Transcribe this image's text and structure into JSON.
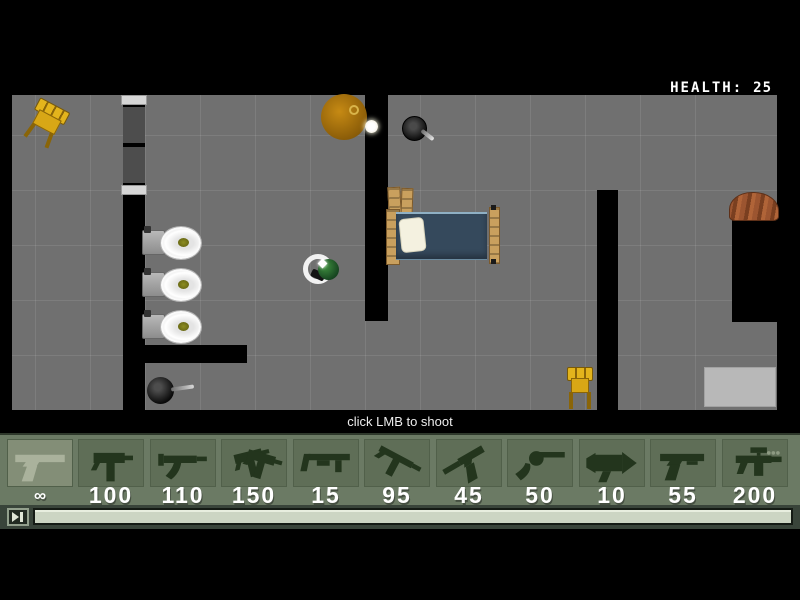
{
  "hud": {
    "health_label": "HEALTH:",
    "health_value": "25",
    "hint": "click LMB to shoot"
  },
  "weapons": {
    "selected_index": 0,
    "items": [
      {
        "name": "desert-eagle",
        "ammo": "∞"
      },
      {
        "name": "uzi",
        "ammo": "100"
      },
      {
        "name": "mp5",
        "ammo": "110"
      },
      {
        "name": "dual-uzis",
        "ammo": "150"
      },
      {
        "name": "shotgun",
        "ammo": "15"
      },
      {
        "name": "tec9-smg",
        "ammo": "95"
      },
      {
        "name": "silenced-pistol",
        "ammo": "45"
      },
      {
        "name": "revolver",
        "ammo": "50"
      },
      {
        "name": "rocket-launcher",
        "ammo": "10"
      },
      {
        "name": "combat-pistol",
        "ammo": "55"
      },
      {
        "name": "scoped-rifle",
        "ammo": "200"
      }
    ]
  },
  "playbar": {
    "progress_percent": 100
  },
  "colors": {
    "floor": "#707070",
    "wall": "#000000",
    "weapon_bar": "#6b7a64",
    "slot": "#5f6e57",
    "slot_selected": "#838e77",
    "ammo_text": "#ffffff",
    "health_text": "#ffffff",
    "blanket": "#35495c",
    "chair": "#d8a716",
    "player": "#2e7d32",
    "progress_fill": "#ccd5c3"
  }
}
